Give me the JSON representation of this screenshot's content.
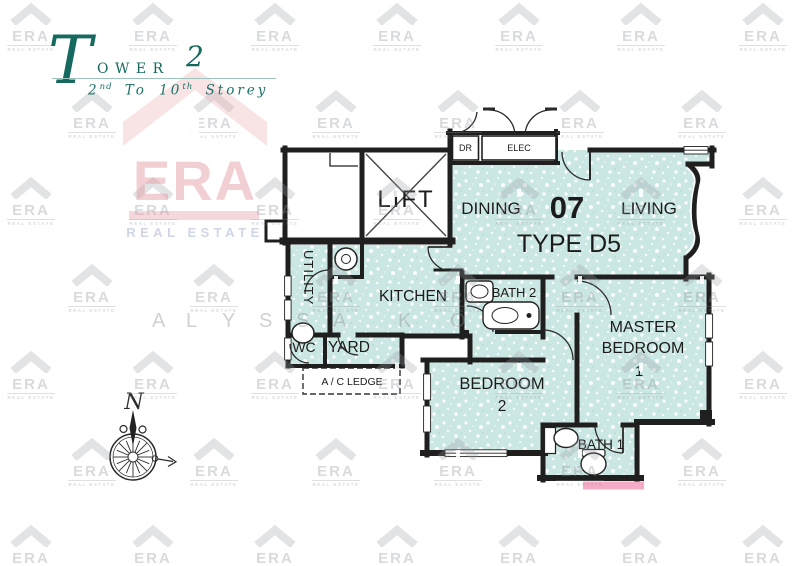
{
  "header": {
    "tower_initial": "T",
    "tower_rest": "OWER",
    "tower_number": "2",
    "storey_start": "2",
    "storey_sup1": "nd",
    "storey_mid": " To 10",
    "storey_sup2": "th",
    "storey_end": " Storey"
  },
  "plan": {
    "lift_label": "LIFT",
    "dr_label": "DR",
    "elec_label": "ELEC",
    "dining_label": "DINING",
    "unit_number": "07",
    "living_label": "LIVING",
    "unit_type": "TYPE D5",
    "kitchen_label": "KITCHEN",
    "utility_label": "UTILITY",
    "wc_label": "WC",
    "yard_label": "YARD",
    "ac_ledge_label": "A / C LEDGE",
    "bath2_label": "BATH 2",
    "master_line1": "MASTER",
    "master_line2": "BEDROOM",
    "master_line3": "1",
    "bedroom2_line1": "BEDROOM",
    "bedroom2_line2": "2",
    "bath1_label": "BATH 1"
  },
  "compass": {
    "north_label": "N"
  },
  "watermark": {
    "brand": "ERA",
    "brand_subtitle": "REAL ESTATE",
    "development_letters": [
      {
        "ch": "A",
        "x": 152
      },
      {
        "ch": "L",
        "x": 186
      },
      {
        "ch": "Y",
        "x": 222
      },
      {
        "ch": "S",
        "x": 259
      },
      {
        "ch": "S",
        "x": 296
      },
      {
        "ch": "A",
        "x": 333
      },
      {
        "ch": "K",
        "x": 398
      },
      {
        "ch": "O",
        "x": 450
      }
    ]
  },
  "colors": {
    "floor": "#cbe7e3",
    "wall": "#1f1f1f",
    "accent_teal": "#15695e",
    "highlight_pink": "#f4abc7",
    "watermark_pink": "#f0cdd2"
  }
}
